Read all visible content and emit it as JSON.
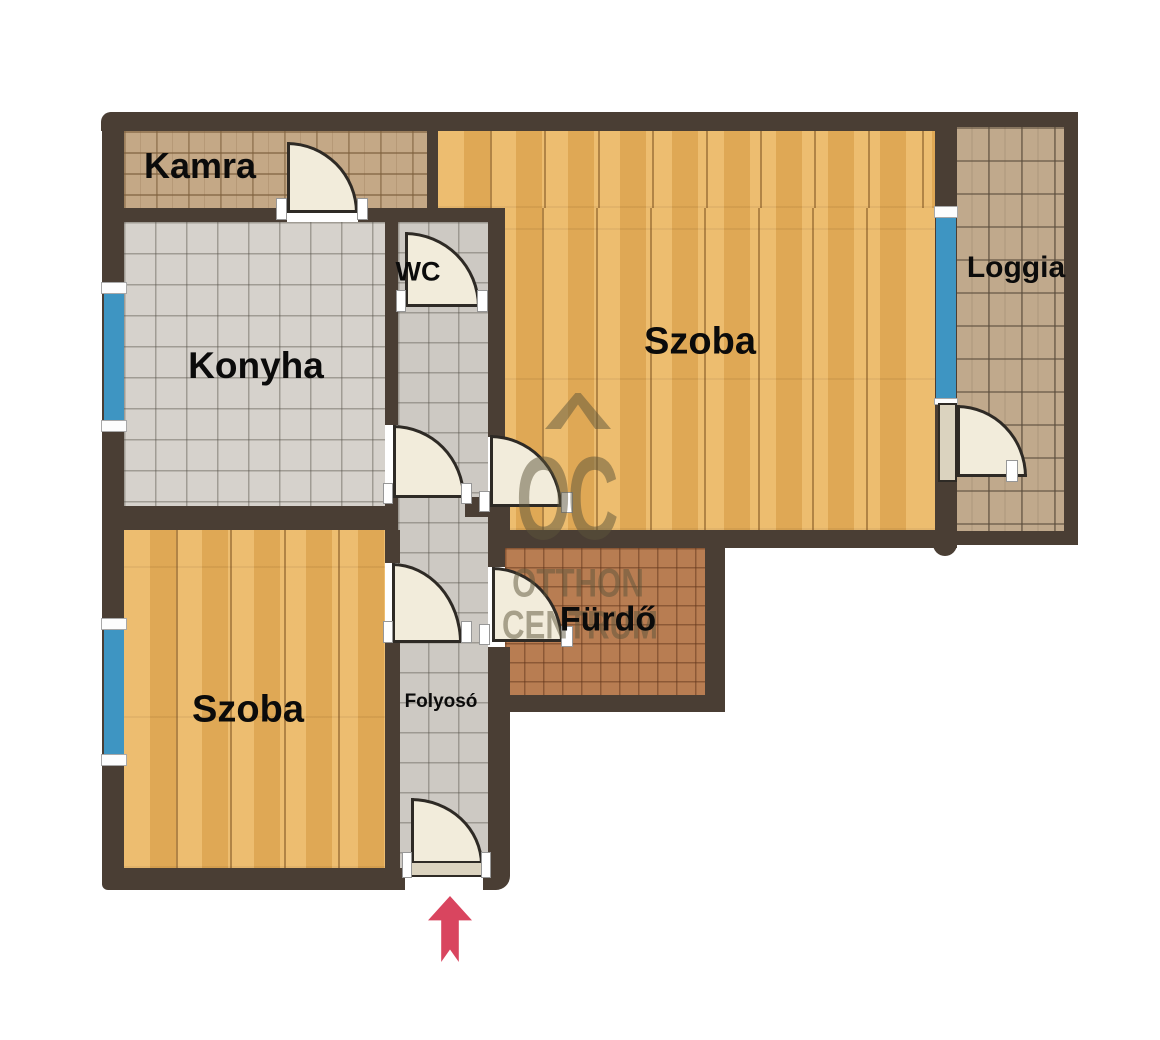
{
  "floorplan": {
    "rooms": [
      {
        "id": "kamra",
        "label": "Kamra",
        "floor": "brick-tile"
      },
      {
        "id": "konyha",
        "label": "Konyha",
        "floor": "ceramic-tile-large"
      },
      {
        "id": "wc",
        "label": "WC",
        "floor": "ceramic-tile-small"
      },
      {
        "id": "szoba-felso",
        "label": "Szoba",
        "floor": "hardwood"
      },
      {
        "id": "loggia",
        "label": "Loggia",
        "floor": "paver-tile"
      },
      {
        "id": "furdo",
        "label": "Fürdő",
        "floor": "terracotta-tile"
      },
      {
        "id": "szoba-also",
        "label": "Szoba",
        "floor": "hardwood"
      },
      {
        "id": "folyoso",
        "label": "Folyosó",
        "floor": "ceramic-tile-small"
      }
    ],
    "watermark": {
      "monogram": "OC",
      "line1": "OTTHON",
      "line2": "CENTRUM"
    },
    "entrance": {
      "symbol": "up-arrow",
      "color": "#d9455f"
    },
    "colors": {
      "wall": "#4a3e34",
      "window": "#3e95c2",
      "door": "#f2ecdb",
      "hardwood": "#e9b25c",
      "kitchen_tile": "#d6d2cc",
      "hall_tile": "#cdc9c3",
      "pantry_tile": "#c4a886",
      "bath_tile": "#b87d52",
      "loggia_tile": "#c0a98c",
      "watermark": "rgba(92,84,58,0.5)"
    }
  }
}
